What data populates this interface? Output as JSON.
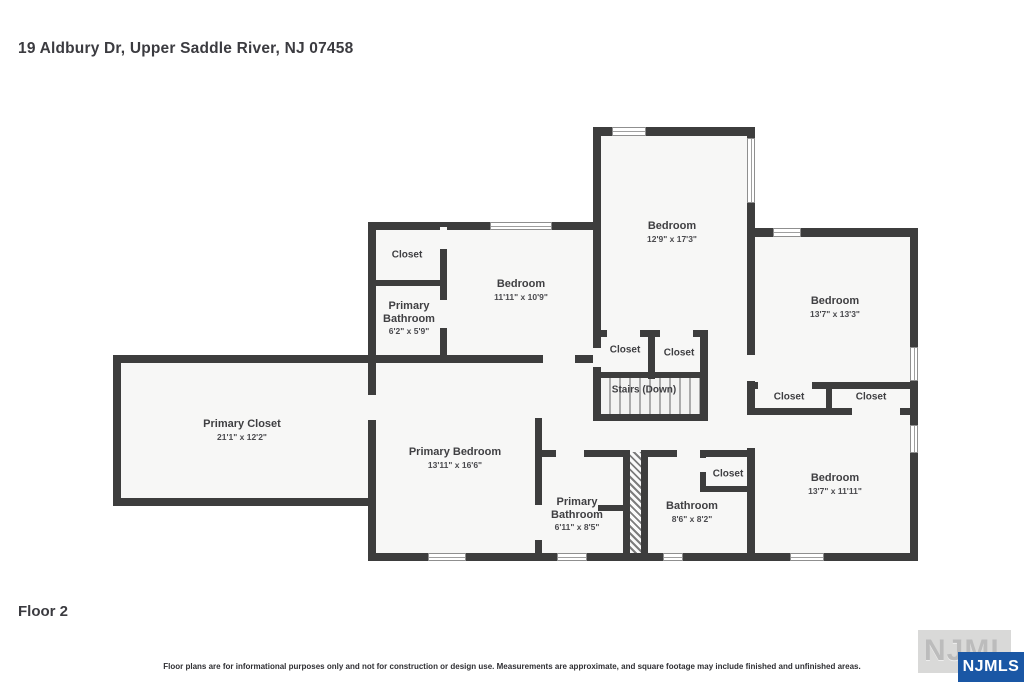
{
  "page": {
    "title": "19 Aldbury Dr, Upper Saddle River, NJ 07458",
    "floor_label": "Floor 2",
    "disclaimer": "Floor plans are for informational purposes only and not for construction or design use. Measurements are approximate, and square footage may include finished and unfinished areas.",
    "watermark_text": "NJMLS",
    "logo_text": "NJMLS"
  },
  "colors": {
    "wall": "#3d3d3d",
    "room_fill": "#f7f7f6",
    "logo_blue": "#1a57a5",
    "text": "#3f3f42"
  },
  "rooms": [
    {
      "id": "closet-top-left",
      "name": "Closet",
      "dims": ""
    },
    {
      "id": "primary-bathroom-upper",
      "name": "Primary Bathroom",
      "dims": "6'2\" x 5'9\""
    },
    {
      "id": "bedroom-top-left",
      "name": "Bedroom",
      "dims": "11'11\" x 10'9\""
    },
    {
      "id": "bedroom-top-middle",
      "name": "Bedroom",
      "dims": "12'9\" x 17'3\""
    },
    {
      "id": "bedroom-top-right",
      "name": "Bedroom",
      "dims": "13'7\" x 13'3\""
    },
    {
      "id": "closet-middle-1",
      "name": "Closet",
      "dims": ""
    },
    {
      "id": "closet-middle-2",
      "name": "Closet",
      "dims": ""
    },
    {
      "id": "stairs",
      "name": "Stairs (Down)",
      "dims": ""
    },
    {
      "id": "closet-right-1",
      "name": "Closet",
      "dims": ""
    },
    {
      "id": "closet-right-2",
      "name": "Closet",
      "dims": ""
    },
    {
      "id": "primary-closet",
      "name": "Primary Closet",
      "dims": "21'1\" x 12'2\""
    },
    {
      "id": "primary-bedroom",
      "name": "Primary Bedroom",
      "dims": "13'11\" x 16'6\""
    },
    {
      "id": "primary-bathroom-lower",
      "name": "Primary Bathroom",
      "dims": "6'11\" x 8'5\""
    },
    {
      "id": "bathroom",
      "name": "Bathroom",
      "dims": "8'6\" x 8'2\""
    },
    {
      "id": "closet-bathroom",
      "name": "Closet",
      "dims": ""
    },
    {
      "id": "bedroom-bottom-right",
      "name": "Bedroom",
      "dims": "13'7\" x 11'11\""
    }
  ]
}
